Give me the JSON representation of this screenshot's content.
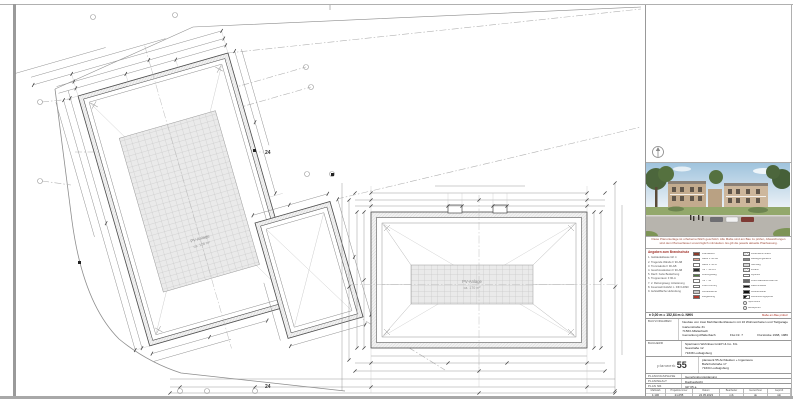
{
  "drawing": {
    "plot_number": "24",
    "left_building": {
      "pv_label": "PV-Anlage",
      "pv_area": "ca. 128 m²"
    },
    "right_building": {
      "pv_label": "PV-Anlage",
      "pv_area": "ca. 170 m²"
    }
  },
  "titleblock": {
    "note": "Diese Planunterlage ist urheberrechtlich geschützt. Alle Maße sind am Bau zu prüfen, Abweichungen sind dem Planverfasser unverzüglich mitzuteilen. Es gilt die jeweils aktuelle Planfassung.",
    "legend": {
      "heading": "Angaben zum Brandschutz",
      "left": [
        "1. Gebäudeklasse GK 4",
        "2. Tragende Wände F 90-AB",
        "3. Trennwände F 90-AB",
        "4. Geschossdecken F 90-AB",
        "5. Dach: harte Bedachung",
        "6. Treppenraum F 90-A",
        "7. 2. Rettungsweg: Anleiterung",
        "8. Feuerwehrzufahrt n. DIN 14090",
        "9. Aufstellfläche Hubrettung"
      ],
      "mid": [
        {
          "color": "#8a3a2a",
          "label": "Brandwand"
        },
        {
          "color": "#e8a393",
          "label": "Wand F 90-AB"
        },
        {
          "color": "#ffffff",
          "label": "Wand F 30-B"
        },
        {
          "color": "#2b2b2b",
          "label": "Tür T 30-RS"
        },
        {
          "color": "#4e7d3c",
          "label": "Rettungsweg"
        },
        {
          "color": "#ffffff",
          "label": "Tür T 90"
        },
        {
          "color": "#ffffff",
          "label": "RWA-Öffnung"
        },
        {
          "color": "#c9c9c9",
          "label": "Aufstellfläche"
        },
        {
          "color": "#b23a2e",
          "label": "Steigleitung"
        }
      ],
      "right": [
        {
          "color": "repeating-linear-gradient(45deg,#9a9a9a 0,#9a9a9a 0.5px,#fff 0.5px,#fff 1.6px)",
          "label": "Feuerwehrzufahrt"
        },
        {
          "color": "#8f8f8f",
          "label": "Bewegungsfläche"
        },
        {
          "color": "#d9d9d9",
          "label": "Gehweg"
        },
        {
          "color": "repeating-linear-gradient(45deg,#9a9a9a 0,#9a9a9a 0.5px,#fff 0.5px,#fff 1.6px)",
          "label": "Zufahrt"
        },
        {
          "color": "#ffffff",
          "label": "Hydrant"
        },
        {
          "color": "#6b6b6b",
          "label": "Löschwasserentnahme"
        },
        {
          "color": "#111111",
          "label": "Rauchmelder"
        },
        {
          "color": "#111111",
          "label": "Anleiterstelle"
        },
        {
          "color": "linear-gradient(135deg,#111 50%,#fff 50%)",
          "label": "Höhenbezugspunkt"
        },
        {
          "color": "#ffffff",
          "label": "Spot-Höhe"
        },
        {
          "color": "#ffffff",
          "label": "Messpunkt"
        }
      ]
    },
    "level_line": "± 0,00 m = 152,64 m ü. NHN",
    "level_note": "Maße am Bau prüfen!",
    "bauvorhaben": {
      "label": "Bauvorhaben",
      "line1": "Neubau von zwei Mehrfamilienhäusern mit 16 Wohneinheiten und Tiefgarage",
      "line2": "Gartenstraße 31",
      "line3": "71563 Affalterbach",
      "line4a": "Gemarkung Affalterbach",
      "line4b": "Flur-Nr. 7",
      "line4c": "Flurstücke 1968, 1986"
    },
    "bauherr": {
      "label": "Bauherr",
      "line1": "Spielmann Wohnbau GmbH & Co. KG",
      "line2": "Seestraße 12",
      "line3": "71638 Ludwigsburg"
    },
    "verfasser": {
      "logo_word": "planwerk",
      "logo_num": "55",
      "line1": "planwerk 55 Architekten + Ingenieure",
      "line2": "Bahnhofstraße 17",
      "line3": "71634 Ludwigsburg"
    },
    "phase": {
      "label": "Planungsphase",
      "value": "Genehmigungsplanung"
    },
    "inhalt": {
      "label": "Planinhalt",
      "value": "Dachaufsicht"
    },
    "plannr": {
      "label": "Plan Nr.",
      "value": "GP 05 a"
    },
    "table": {
      "headers": [
        "Maßstab",
        "Projektnummer",
        "Datum",
        "Bearbeiter",
        "Gezeichnet",
        "Geprüft"
      ],
      "values": [
        "1:100",
        "21-055",
        "24.05.2023",
        "mb",
        "sk",
        "mb"
      ]
    }
  }
}
